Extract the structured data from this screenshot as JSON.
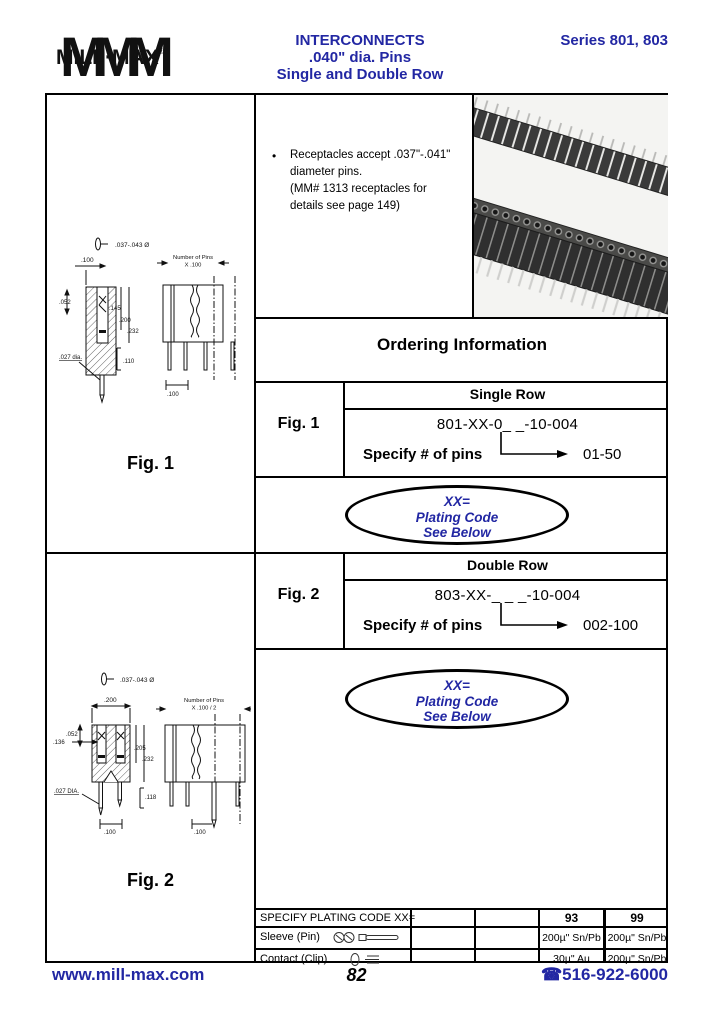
{
  "header": {
    "logo_mmm": "MMM",
    "logo_text": "MILL·MAX",
    "logo_reg": "®",
    "title_line1": "INTERCONNECTS",
    "title_line2": ".040\" dia. Pins",
    "title_line3": "Single and Double Row",
    "series": "Series 801, 803"
  },
  "colors": {
    "brand_blue": "#2227a3",
    "line_black": "#000000",
    "photo_bg": "#f4f4f2"
  },
  "notes": {
    "bullet": "•",
    "lines": [
      "Receptacles accept .037\"-.041\"",
      "diameter pins.",
      "(MM# 1313 receptacles for",
      "details see page 149)"
    ]
  },
  "ordering": {
    "title": "Ordering Information",
    "single": {
      "fig": "Fig. 1",
      "row_label": "Single Row",
      "part_number": "801-XX-0_ _-10-004",
      "specify": "Specify # of pins",
      "range": "01-50"
    },
    "double": {
      "fig": "Fig. 2",
      "row_label": "Double Row",
      "part_number": "803-XX-_ _ _-10-004",
      "specify": "Specify # of pins",
      "range": "002-100"
    },
    "plating_note": {
      "line1": "XX=",
      "line2": "Plating Code",
      "line3": "See Below"
    }
  },
  "figures": {
    "fig1": {
      "caption": "Fig. 1",
      "pin_dia": ".037-.043 Ø",
      "pins_note1": "Number of Pins",
      "pins_note2": "X .100",
      "dims": {
        "top": ".100",
        "left": ".052",
        "d1": ".145",
        "d2": ".200",
        "d3": ".232",
        "dia": ".027 dia.",
        "d4": ".110",
        "bottom": ".100"
      }
    },
    "fig2": {
      "caption": "Fig. 2",
      "pin_dia": ".037-.043 Ø",
      "pins_note1": "Number of Pins",
      "pins_note2": "X .100 / 2",
      "dims": {
        "top": ".200",
        "left": ".052",
        "d1": ".136",
        "d2": ".205",
        "d3": ".232",
        "dia": ".027 DIA.",
        "d4": ".118",
        "bottom_left": ".100",
        "bottom_right": ".100"
      }
    }
  },
  "plating_table": {
    "title": "SPECIFY PLATING CODE XX=",
    "col_93": "93",
    "col_99": "99",
    "rows": [
      {
        "label": "Sleeve (Pin)",
        "v93": "200µ\" Sn/Pb",
        "v99": "200µ\" Sn/Pb"
      },
      {
        "label": "Contact (Clip)",
        "v93": "30µ\" Au",
        "v99": "200µ\" Sn/Pb"
      }
    ]
  },
  "footer": {
    "website": "www.mill-max.com",
    "page": "82",
    "phone_icon": "☎",
    "phone": "516-922-6000"
  }
}
